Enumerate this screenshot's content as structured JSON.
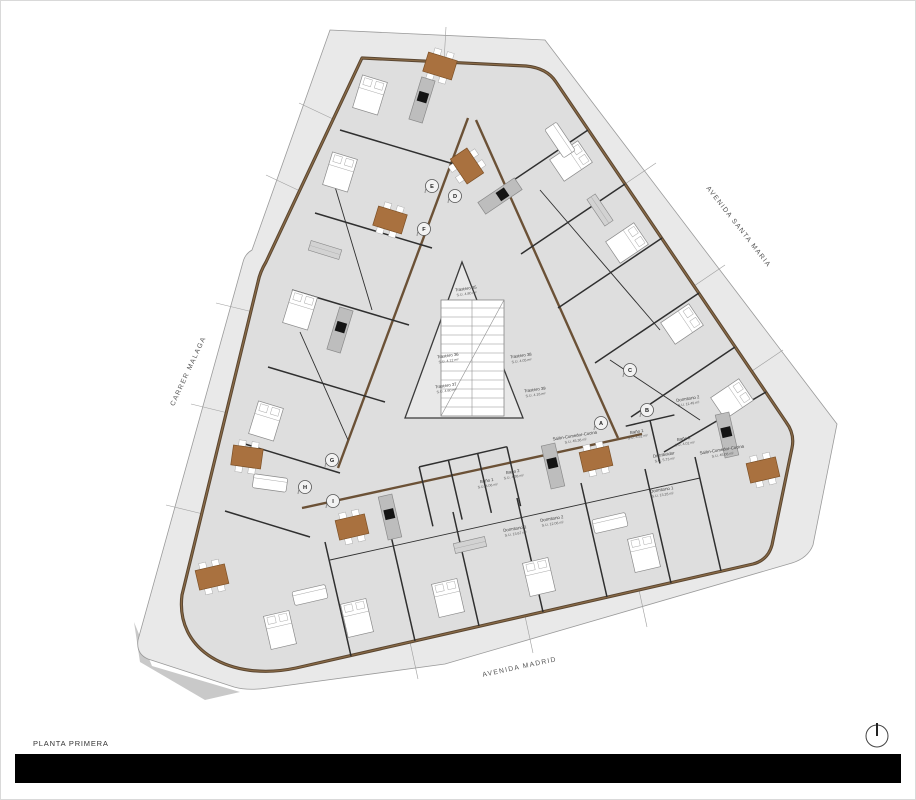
{
  "title": {
    "label": "PLANTA PRIMERA"
  },
  "streets": {
    "left": "CARRER MALAGA",
    "right": "AVENIDA SANTA MARIA",
    "bottom": "AVENIDA MADRID"
  },
  "storage": [
    {
      "name": "Trastero 35",
      "area": "S.U. 4.80 m²"
    },
    {
      "name": "Trastero 36",
      "area": "S.U. 4.12 m²"
    },
    {
      "name": "Trastero 38",
      "area": "S.U. 4.05 m²"
    },
    {
      "name": "Trastero 37",
      "area": "S.U. 4.60 m²"
    },
    {
      "name": "Trastero 39",
      "area": "S.U. 4.16 m²"
    }
  ],
  "apartment_center": [
    {
      "name": "Salón-Comedor-Cocina",
      "area": "S.U. 45.38 m²"
    },
    {
      "name": "Baño 1",
      "area": "S.U. 4.06 m²"
    },
    {
      "name": "Baño 2",
      "area": "S.U. 4.38 m²"
    },
    {
      "name": "Dormitorio 1",
      "area": "S.U. 13.67 m²"
    },
    {
      "name": "Dormitorio 2",
      "area": "S.U. 12.06 m²"
    }
  ],
  "apartment_east": [
    {
      "name": "Dormitorio 2",
      "area": "S.U. 11.49 m²"
    },
    {
      "name": "Baño 1",
      "area": "S.U. 4.52 m²"
    },
    {
      "name": "Baño 2",
      "area": "S.U. 4.02 m²"
    },
    {
      "name": "Distribuidor",
      "area": "S.U. 5.73 m²"
    },
    {
      "name": "Dormitorio 1",
      "area": "S.U. 13.28 m²"
    },
    {
      "name": "Salón-Comedor-Cocina",
      "area": "S.U. 45.08 m²"
    }
  ],
  "entrances": [
    "A",
    "B",
    "C",
    "D",
    "E",
    "F",
    "G",
    "H",
    "I"
  ],
  "colors": {
    "pavement": "#e9e9e9",
    "floor": "#dedede",
    "wall_brown": "#6b5136",
    "wall_dark": "#2f2f2f",
    "table_wood": "#a9713f",
    "counter_gray": "#bdbdbd",
    "cooktop_black": "#141414",
    "footer_bar": "#000000"
  }
}
